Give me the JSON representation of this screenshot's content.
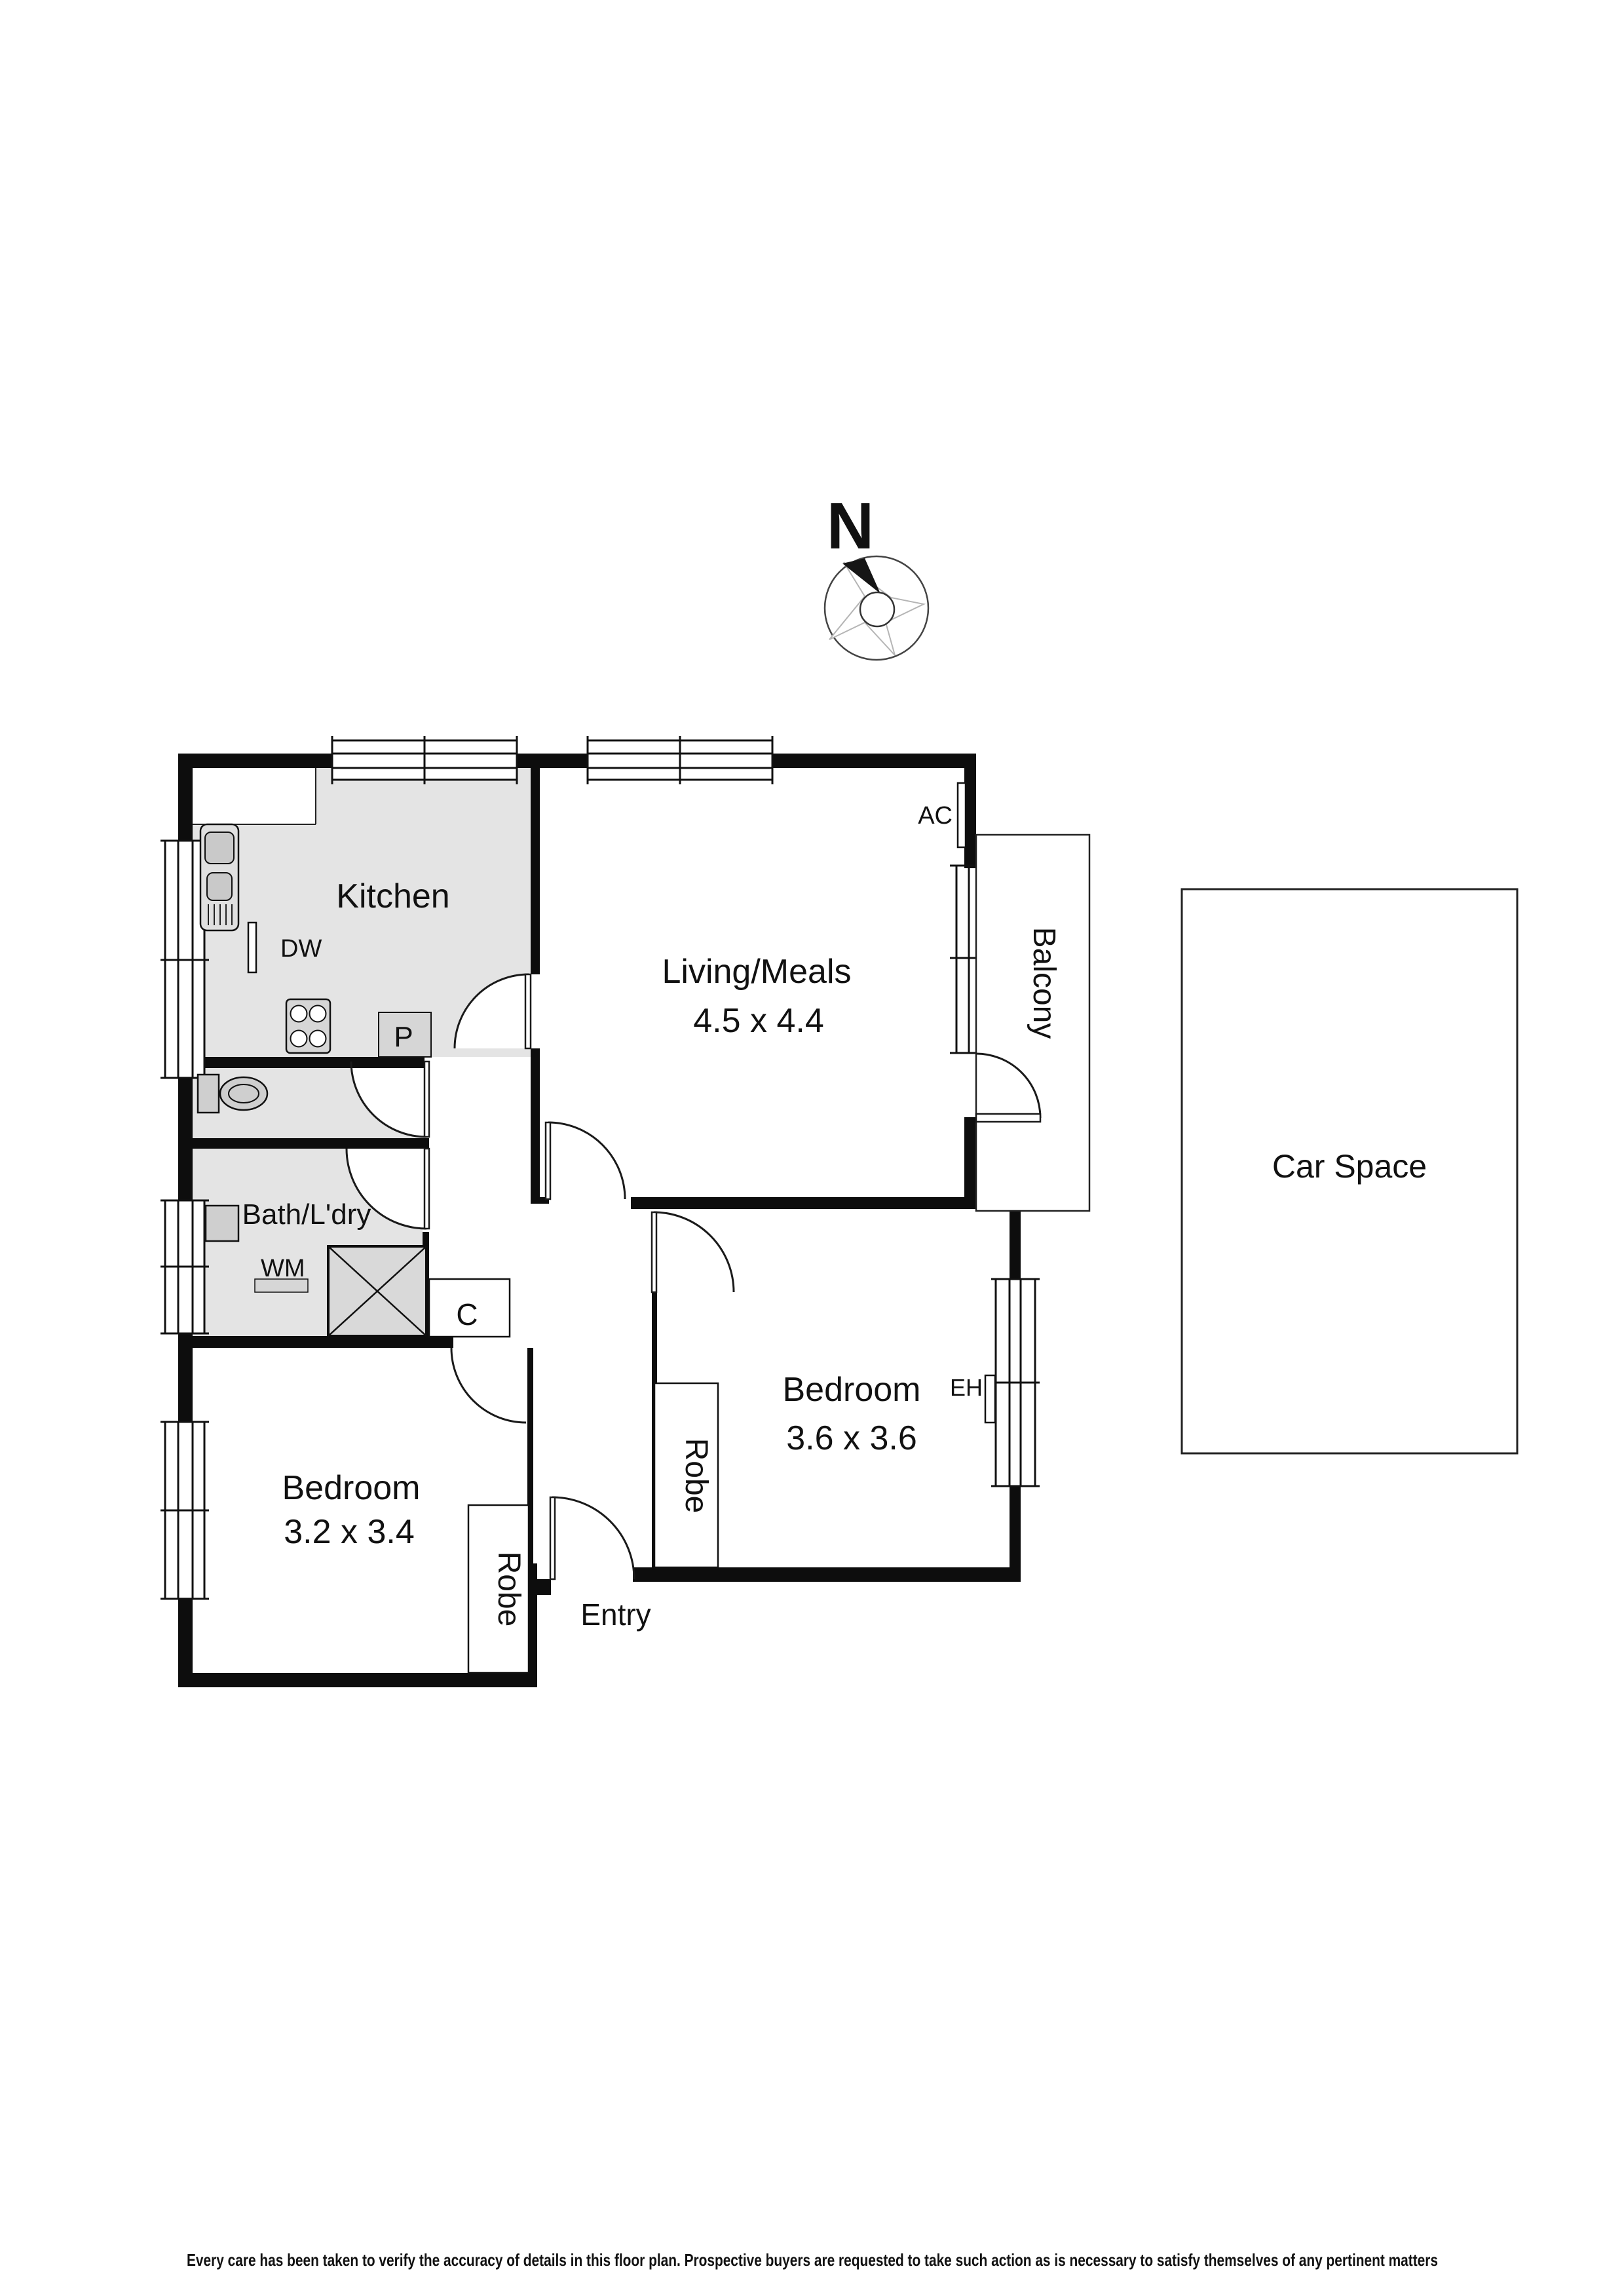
{
  "compass": {
    "north_label": "N"
  },
  "rooms": {
    "kitchen": {
      "label": "Kitchen"
    },
    "living": {
      "label": "Living/Meals",
      "dimensions": "4.5 x 4.4"
    },
    "balcony": {
      "label": "Balcony"
    },
    "car_space": {
      "label": "Car Space"
    },
    "bath_laundry": {
      "label": "Bath/L'dry"
    },
    "bedroom_main": {
      "label": "Bedroom",
      "dimensions": "3.6 x 3.6"
    },
    "bedroom_second": {
      "label": "Bedroom",
      "dimensions": "3.2 x 3.4"
    },
    "entry": {
      "label": "Entry"
    }
  },
  "fixtures": {
    "dishwasher": {
      "label": "DW"
    },
    "pantry": {
      "label": "P"
    },
    "air_conditioner": {
      "label": "AC"
    },
    "washing_machine": {
      "label": "WM"
    },
    "cupboard": {
      "label": "C"
    },
    "electric_heater": {
      "label": "EH"
    },
    "robe_main": {
      "label": "Robe"
    },
    "robe_second": {
      "label": "Robe"
    }
  },
  "footer": {
    "disclaimer": "Every care has been taken to verify the accuracy of details in this floor plan. Prospective buyers are requested to take such action as is necessary to satisfy themselves of any pertinent matters"
  }
}
